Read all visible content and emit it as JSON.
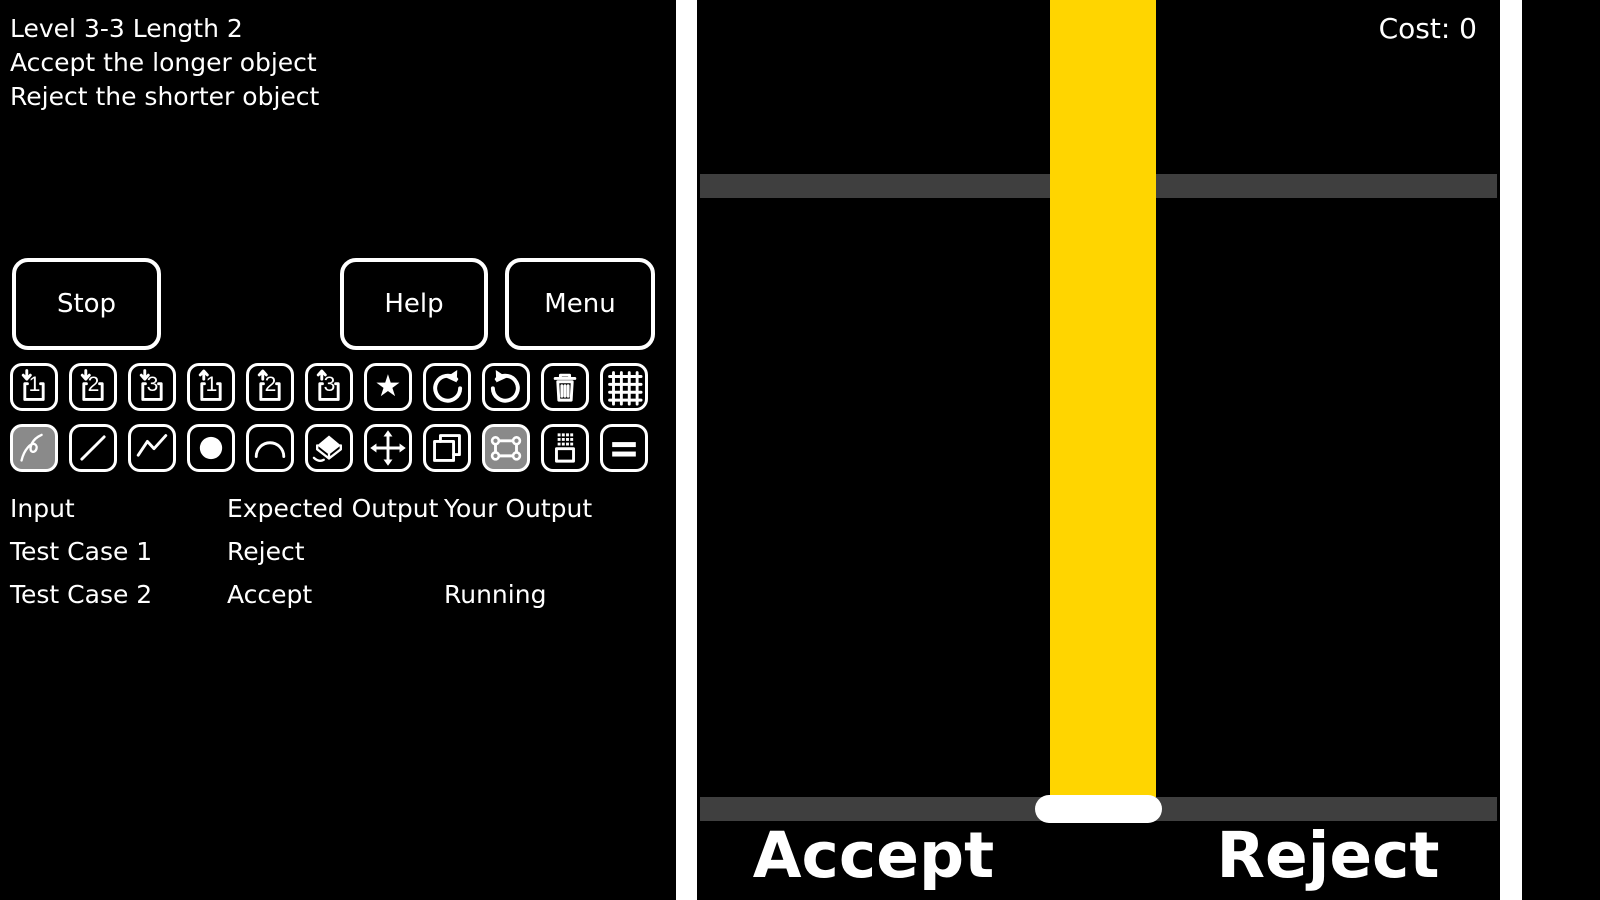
{
  "window": {
    "width": 1600,
    "height": 900,
    "background": "#000000"
  },
  "left_panel": {
    "level_info": {
      "title": "Level 3-3 Length 2",
      "goal_line1": "Accept the longer object",
      "goal_line2": "Reject the shorter object"
    },
    "buttons": {
      "stop": "Stop",
      "help": "Help",
      "menu": "Menu"
    },
    "toolbar": {
      "row1": [
        {
          "name": "save-slot-1",
          "digit": "1"
        },
        {
          "name": "save-slot-2",
          "digit": "2"
        },
        {
          "name": "save-slot-3",
          "digit": "3"
        },
        {
          "name": "load-slot-1",
          "digit": "1"
        },
        {
          "name": "load-slot-2",
          "digit": "2"
        },
        {
          "name": "load-slot-3",
          "digit": "3"
        },
        {
          "name": "favorite",
          "glyph": "★"
        },
        {
          "name": "undo"
        },
        {
          "name": "redo"
        },
        {
          "name": "delete"
        },
        {
          "name": "grid-toggle"
        }
      ],
      "row2": [
        {
          "name": "freehand-tool",
          "selected": true
        },
        {
          "name": "line-tool"
        },
        {
          "name": "polyline-tool"
        },
        {
          "name": "circle-tool"
        },
        {
          "name": "arc-tool"
        },
        {
          "name": "eraser-tool"
        },
        {
          "name": "move-tool"
        },
        {
          "name": "copy-tool"
        },
        {
          "name": "select-tool",
          "selected": true
        },
        {
          "name": "spray-box-tool"
        },
        {
          "name": "double-bar-tool"
        }
      ]
    },
    "test_table": {
      "headers": {
        "input": "Input",
        "expected": "Expected Output",
        "yours": "Your Output"
      },
      "rows": [
        {
          "input": "Test Case 1",
          "expected": "Reject",
          "yours": ""
        },
        {
          "input": "Test Case 2",
          "expected": "Accept",
          "yours": "Running"
        }
      ]
    }
  },
  "game_panel": {
    "cost_label": "Cost: 0",
    "accept_label": "Accept",
    "reject_label": "Reject",
    "colors": {
      "chute_yellow": "#FFD500",
      "platform_gray": "#3F3F3F",
      "selected_tool_bg": "#8A8A8A",
      "wall_white": "#FFFFFF"
    }
  }
}
